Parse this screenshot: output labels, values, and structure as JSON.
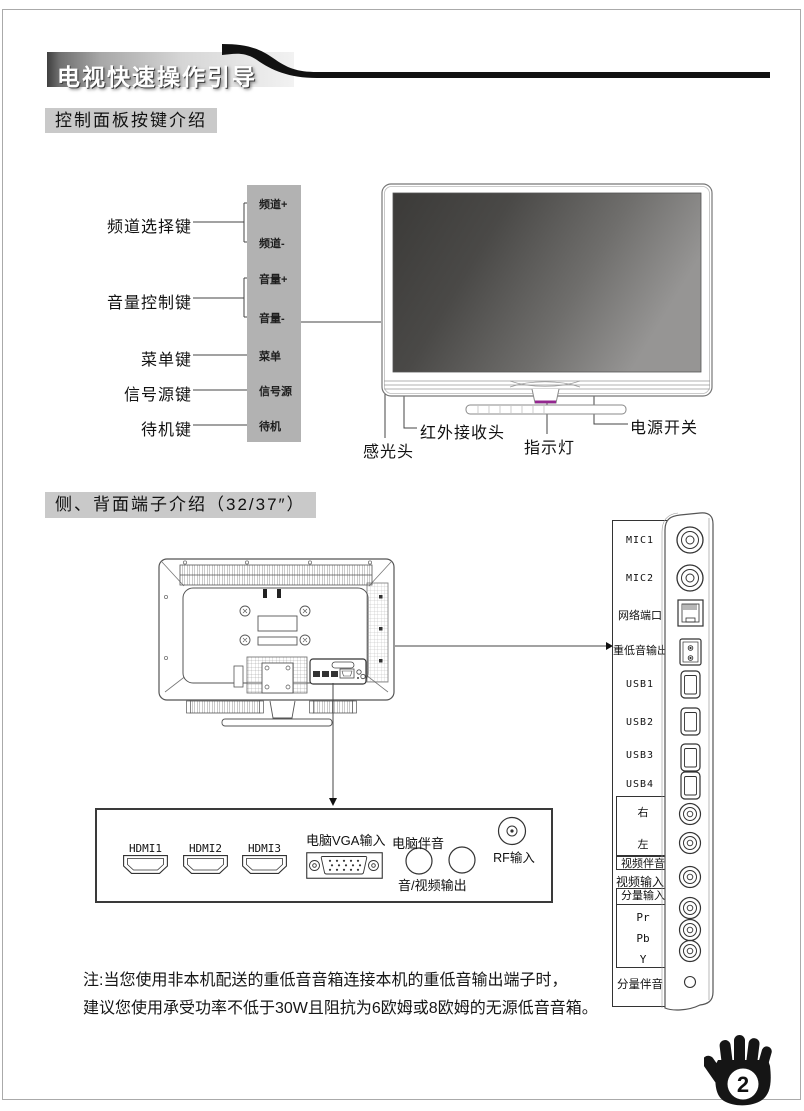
{
  "banner": {
    "title": "电视快速操作引导"
  },
  "section1": {
    "heading": "控制面板按键介绍",
    "left_labels": [
      "频道选择键",
      "音量控制键",
      "菜单键",
      "信号源键",
      "待机键"
    ],
    "panel_buttons": [
      "频道+",
      "频道-",
      "音量+",
      "音量-",
      "菜单",
      "信号源",
      "待机"
    ],
    "tv_callouts": [
      "感光头",
      "红外接收头",
      "指示灯",
      "电源开关"
    ]
  },
  "section2": {
    "heading": "侧、背面端子介绍（32/37″）",
    "side_labels": [
      "MIC1",
      "MIC2",
      "网络端口",
      "重低音输出",
      "USB1",
      "USB2",
      "USB3",
      "USB4"
    ],
    "av_group": {
      "right": "右",
      "left": "左",
      "box_label": "视频伴音"
    },
    "video_in": "视频输入",
    "component_group": {
      "label": "分量输入",
      "channels": [
        "Pr",
        "Pb",
        "Y"
      ]
    },
    "component_audio": "分量伴音",
    "bottom_panel": {
      "hdmi": [
        "HDMI1",
        "HDMI2",
        "HDMI3"
      ],
      "vga": "电脑VGA输入",
      "pc_audio": "电脑伴音",
      "av_out": "音/视频输出",
      "rf": "RF输入"
    }
  },
  "note": {
    "line1": "注:当您使用非本机配送的重低音音箱连接本机的重低音输出端子时，",
    "line2": "建议您使用承受功率不低于30W且阻抗为6欧姆或8欧姆的无源低音音箱。"
  },
  "footer": {
    "page_number": "2",
    "icon": "hand-icon"
  },
  "colors": {
    "accent_purple": "#93278f",
    "panel_gray": "#b2b2b2",
    "heading_bg": "#c9c9c9",
    "screen_dark": "#3b3a38",
    "screen_light": "#969594",
    "line_color": "#444444"
  }
}
